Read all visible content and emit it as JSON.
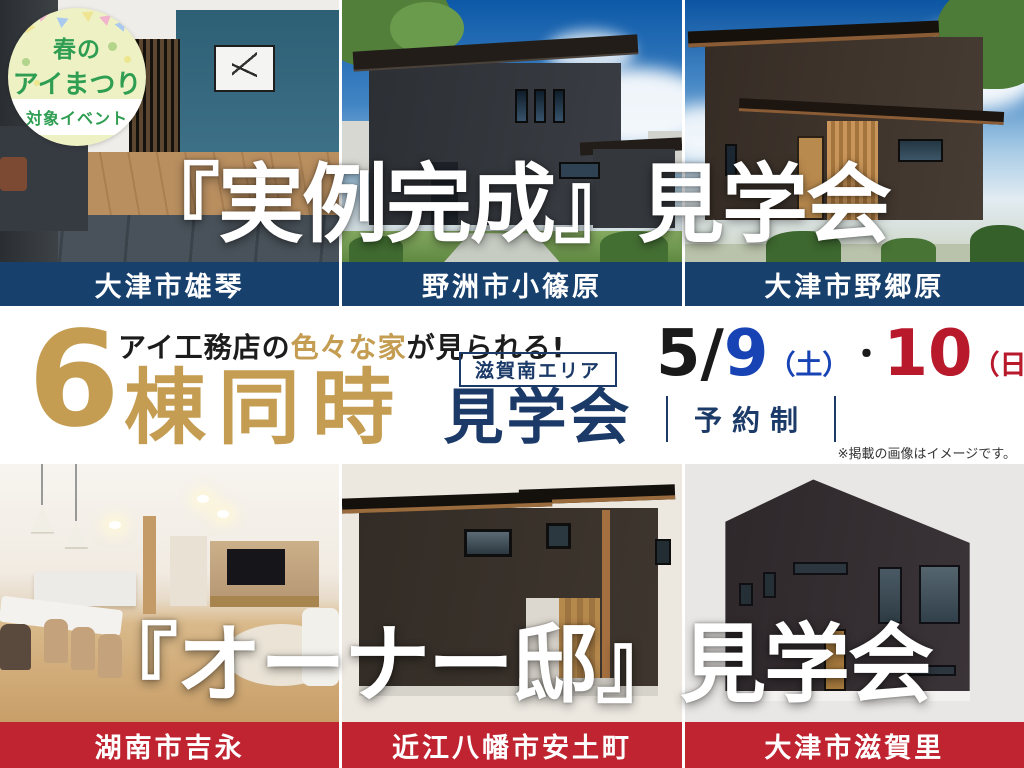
{
  "badge": {
    "line1": "春の",
    "line2": "アイまつり",
    "label": "対象イベント"
  },
  "top_event": {
    "title": "『実例完成』見学会",
    "locations": [
      "大津市雄琴",
      "野洲市小篠原",
      "大津市野郷原"
    ]
  },
  "campaign": {
    "catch_prefix": "アイ工務店の",
    "catch_highlight": "色々な家",
    "catch_suffix": "が見られる!",
    "count": "6",
    "count_unit": "棟同時",
    "area_label": "滋賀南エリア",
    "event_word": "見学会",
    "date": {
      "month": "5/",
      "day1": "9",
      "day1_week": "（土）",
      "dot": "・",
      "day2": "10",
      "day2_week": "（日）"
    },
    "reservation": "予約制",
    "disclaimer": "※掲載の画像はイメージです。"
  },
  "bottom_event": {
    "title": "『オーナー邸』見学会",
    "locations": [
      "湖南市吉永",
      "近江八幡市安土町",
      "大津市滋賀里"
    ]
  },
  "colors": {
    "navy_bar": "#17406d",
    "red_bar": "#bf2430",
    "gold": "#c49d52",
    "navy_text": "#1b3a68",
    "date_blue": "#1743b5",
    "date_red": "#b81a2c",
    "badge_bg": "#eef1c4",
    "badge_green": "#2f9e52"
  }
}
